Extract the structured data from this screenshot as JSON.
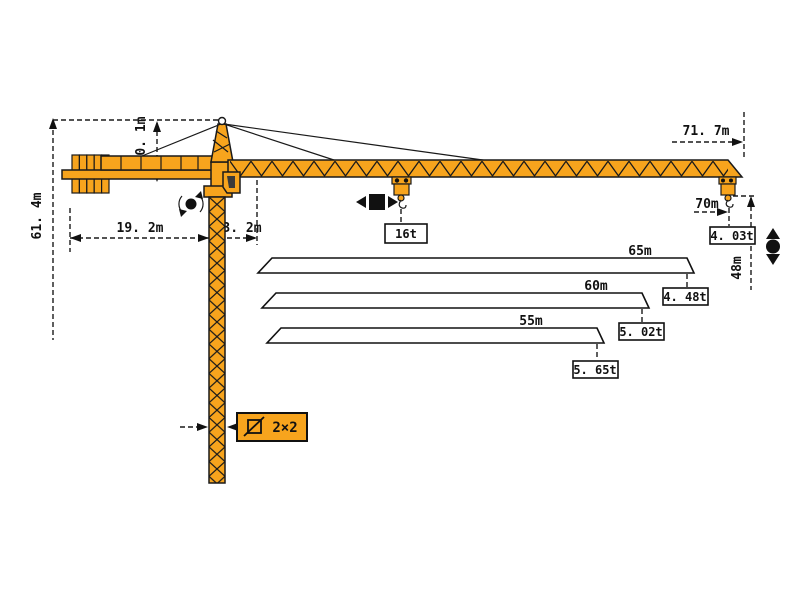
{
  "diagram": {
    "title": "tower-crane-working-range-diagram",
    "colors": {
      "crane_body": "#f7a41d",
      "outline": "#1a1a1a",
      "background": "#ffffff"
    },
    "dimensions": {
      "total_height": "61. 4m",
      "head_height": "10. 1m",
      "counter_jib_length": "19. 2m",
      "tower_offset": "3. 2m",
      "max_radius": "71. 7m",
      "tip_radius": "70m",
      "hook_height": "48m"
    },
    "mast_section": {
      "symbol": "square-section",
      "value": "2×2"
    },
    "loads": {
      "max_load": "16t",
      "tip_load": "4. 03t"
    },
    "jib_options": [
      {
        "length": "65m",
        "tip_load": "4. 48t"
      },
      {
        "length": "60m",
        "tip_load": "5. 02t"
      },
      {
        "length": "55m",
        "tip_load": "5. 65t"
      }
    ],
    "symbols": {
      "slewing": "rotation-arrows-around-dot",
      "trolley_travel": "square-with-left-right-arrows",
      "hoisting": "dot-with-up-down-arrows"
    }
  }
}
